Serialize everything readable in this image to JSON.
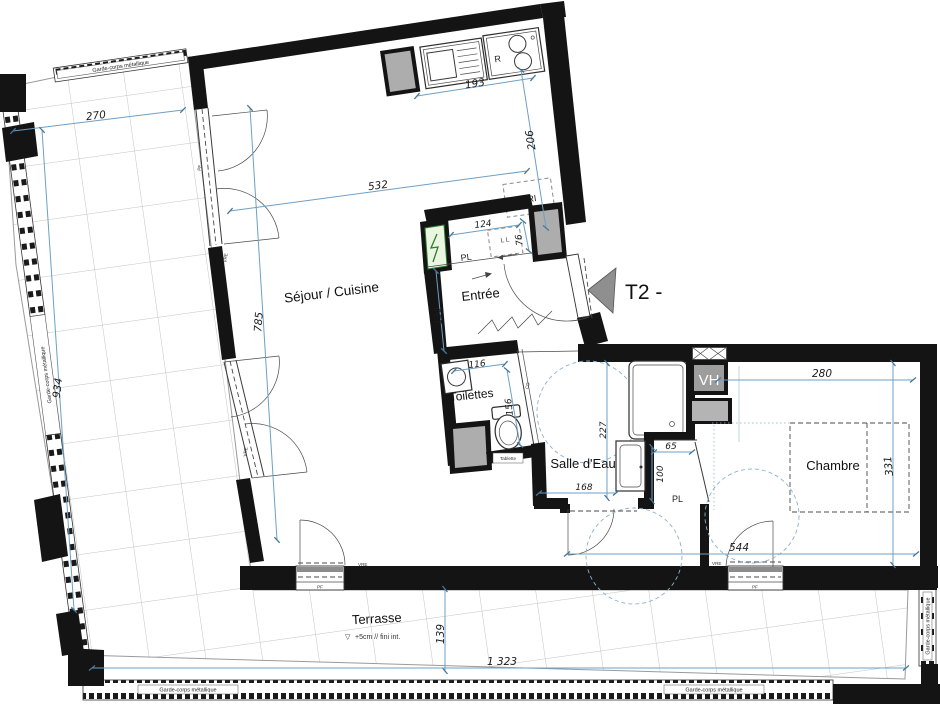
{
  "plan": {
    "unit_label": "T2 -",
    "rooms": {
      "sejour_cuisine": "Séjour / Cuisine",
      "entree": "Entrée",
      "toilettes": "Toilettes",
      "salle_deau": "Salle d'Eau",
      "chambre": "Chambre",
      "terrasse": "Terrasse"
    },
    "terrace": {
      "level_symbol": "▽",
      "note": "+5cm // fini int.",
      "railing_label": "Garde-corps métallique"
    },
    "annotations": {
      "closet_entree": "PL",
      "closet_chambre": "PL",
      "waste_sorting": "TRI",
      "washing_machine": "L L",
      "sliding_door": "CD",
      "high_vent": "VH",
      "appliance_r": "R",
      "shelf": "Tablette",
      "roller_shutter": "VRE",
      "french_window": "PF"
    },
    "dimensions": {
      "terrace_top_width": "270",
      "terrace_left_length": "934",
      "sejour_width": "532",
      "sejour_height": "785",
      "kitchen_run": "193",
      "kitchen_depth": "206",
      "entree_closet_width": "124",
      "entree_closet_depth": "76",
      "entree_width": "130",
      "toilettes_width": "116",
      "toilettes_depth": "156",
      "salle_deau_height": "227",
      "salle_deau_width": "168",
      "closet_chambre_width": "65",
      "closet_chambre_depth": "100",
      "chambre_width": "280",
      "chambre_depth": "331",
      "south_span": "544",
      "terrace_bottom_depth": "139",
      "terrace_bottom_width": "1 323"
    },
    "colors": {
      "wall": "#141414",
      "dimension_blue": "#6f9fc4",
      "duct_gray": "#adadad",
      "panel_green": "#2d7d2d"
    }
  }
}
